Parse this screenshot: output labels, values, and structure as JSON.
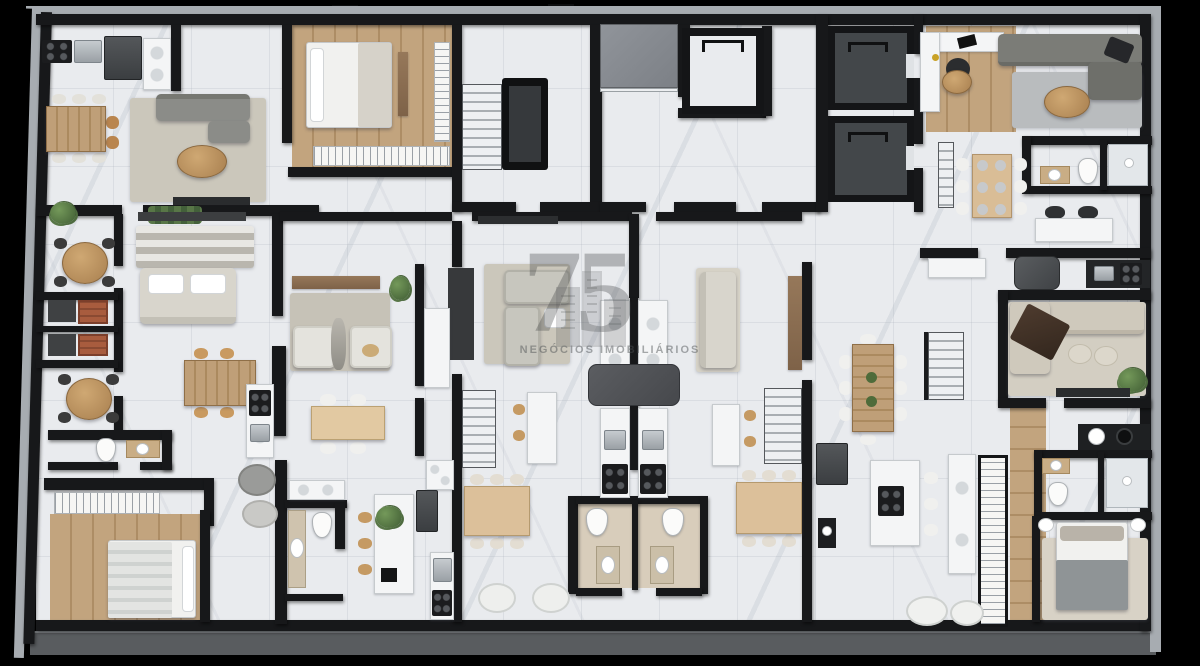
{
  "scene": {
    "title": "Residential building floor plan – 3D top-down render",
    "style": "marble floors, dark walls, furnished apartment units"
  },
  "watermark": {
    "logo_numeral": "75",
    "caption": "NEGÓCIOS IMOBILIÁRIOS"
  },
  "palette": {
    "background": "#000000",
    "wall": "#17181a",
    "slab": "#a7acb1",
    "slab_strip": "#595c5f",
    "floor": "#e9ebee",
    "wood_floor": "#c2a47e",
    "wood": "#bf9f78",
    "rug": "#cbc7bb",
    "rug_gray": "#b9bcbe",
    "sofa_gray": "#8b8c88",
    "sofa_light": "#c7c6be",
    "sofa_beige": "#d8d5cc",
    "counter": "#f4f5f6",
    "appliance": "#45484b",
    "cooktop": "#1b1c1e",
    "steel": "#b9bec2",
    "tile": "#d8cdbb",
    "core_floor": "#43474a",
    "concrete": "#888c90",
    "plant": "#567a43",
    "brick": "#a85c3e",
    "watermark": "#3c3e40"
  },
  "symbols": {
    "legend": [
      "wall",
      "marble-floor",
      "wood-floor",
      "rug",
      "sofa",
      "bed",
      "dining-table",
      "coffee-table",
      "chair",
      "bar-stool",
      "kitchen-counter",
      "kitchen-island",
      "cooktop",
      "sink",
      "fridge",
      "toilet",
      "washbasin",
      "shower",
      "bbq-grill",
      "balcony-table",
      "wardrobe",
      "stairs",
      "elevator",
      "concrete-landing",
      "tv-console",
      "desk",
      "plant",
      "lounge-chair",
      "pouf"
    ]
  }
}
